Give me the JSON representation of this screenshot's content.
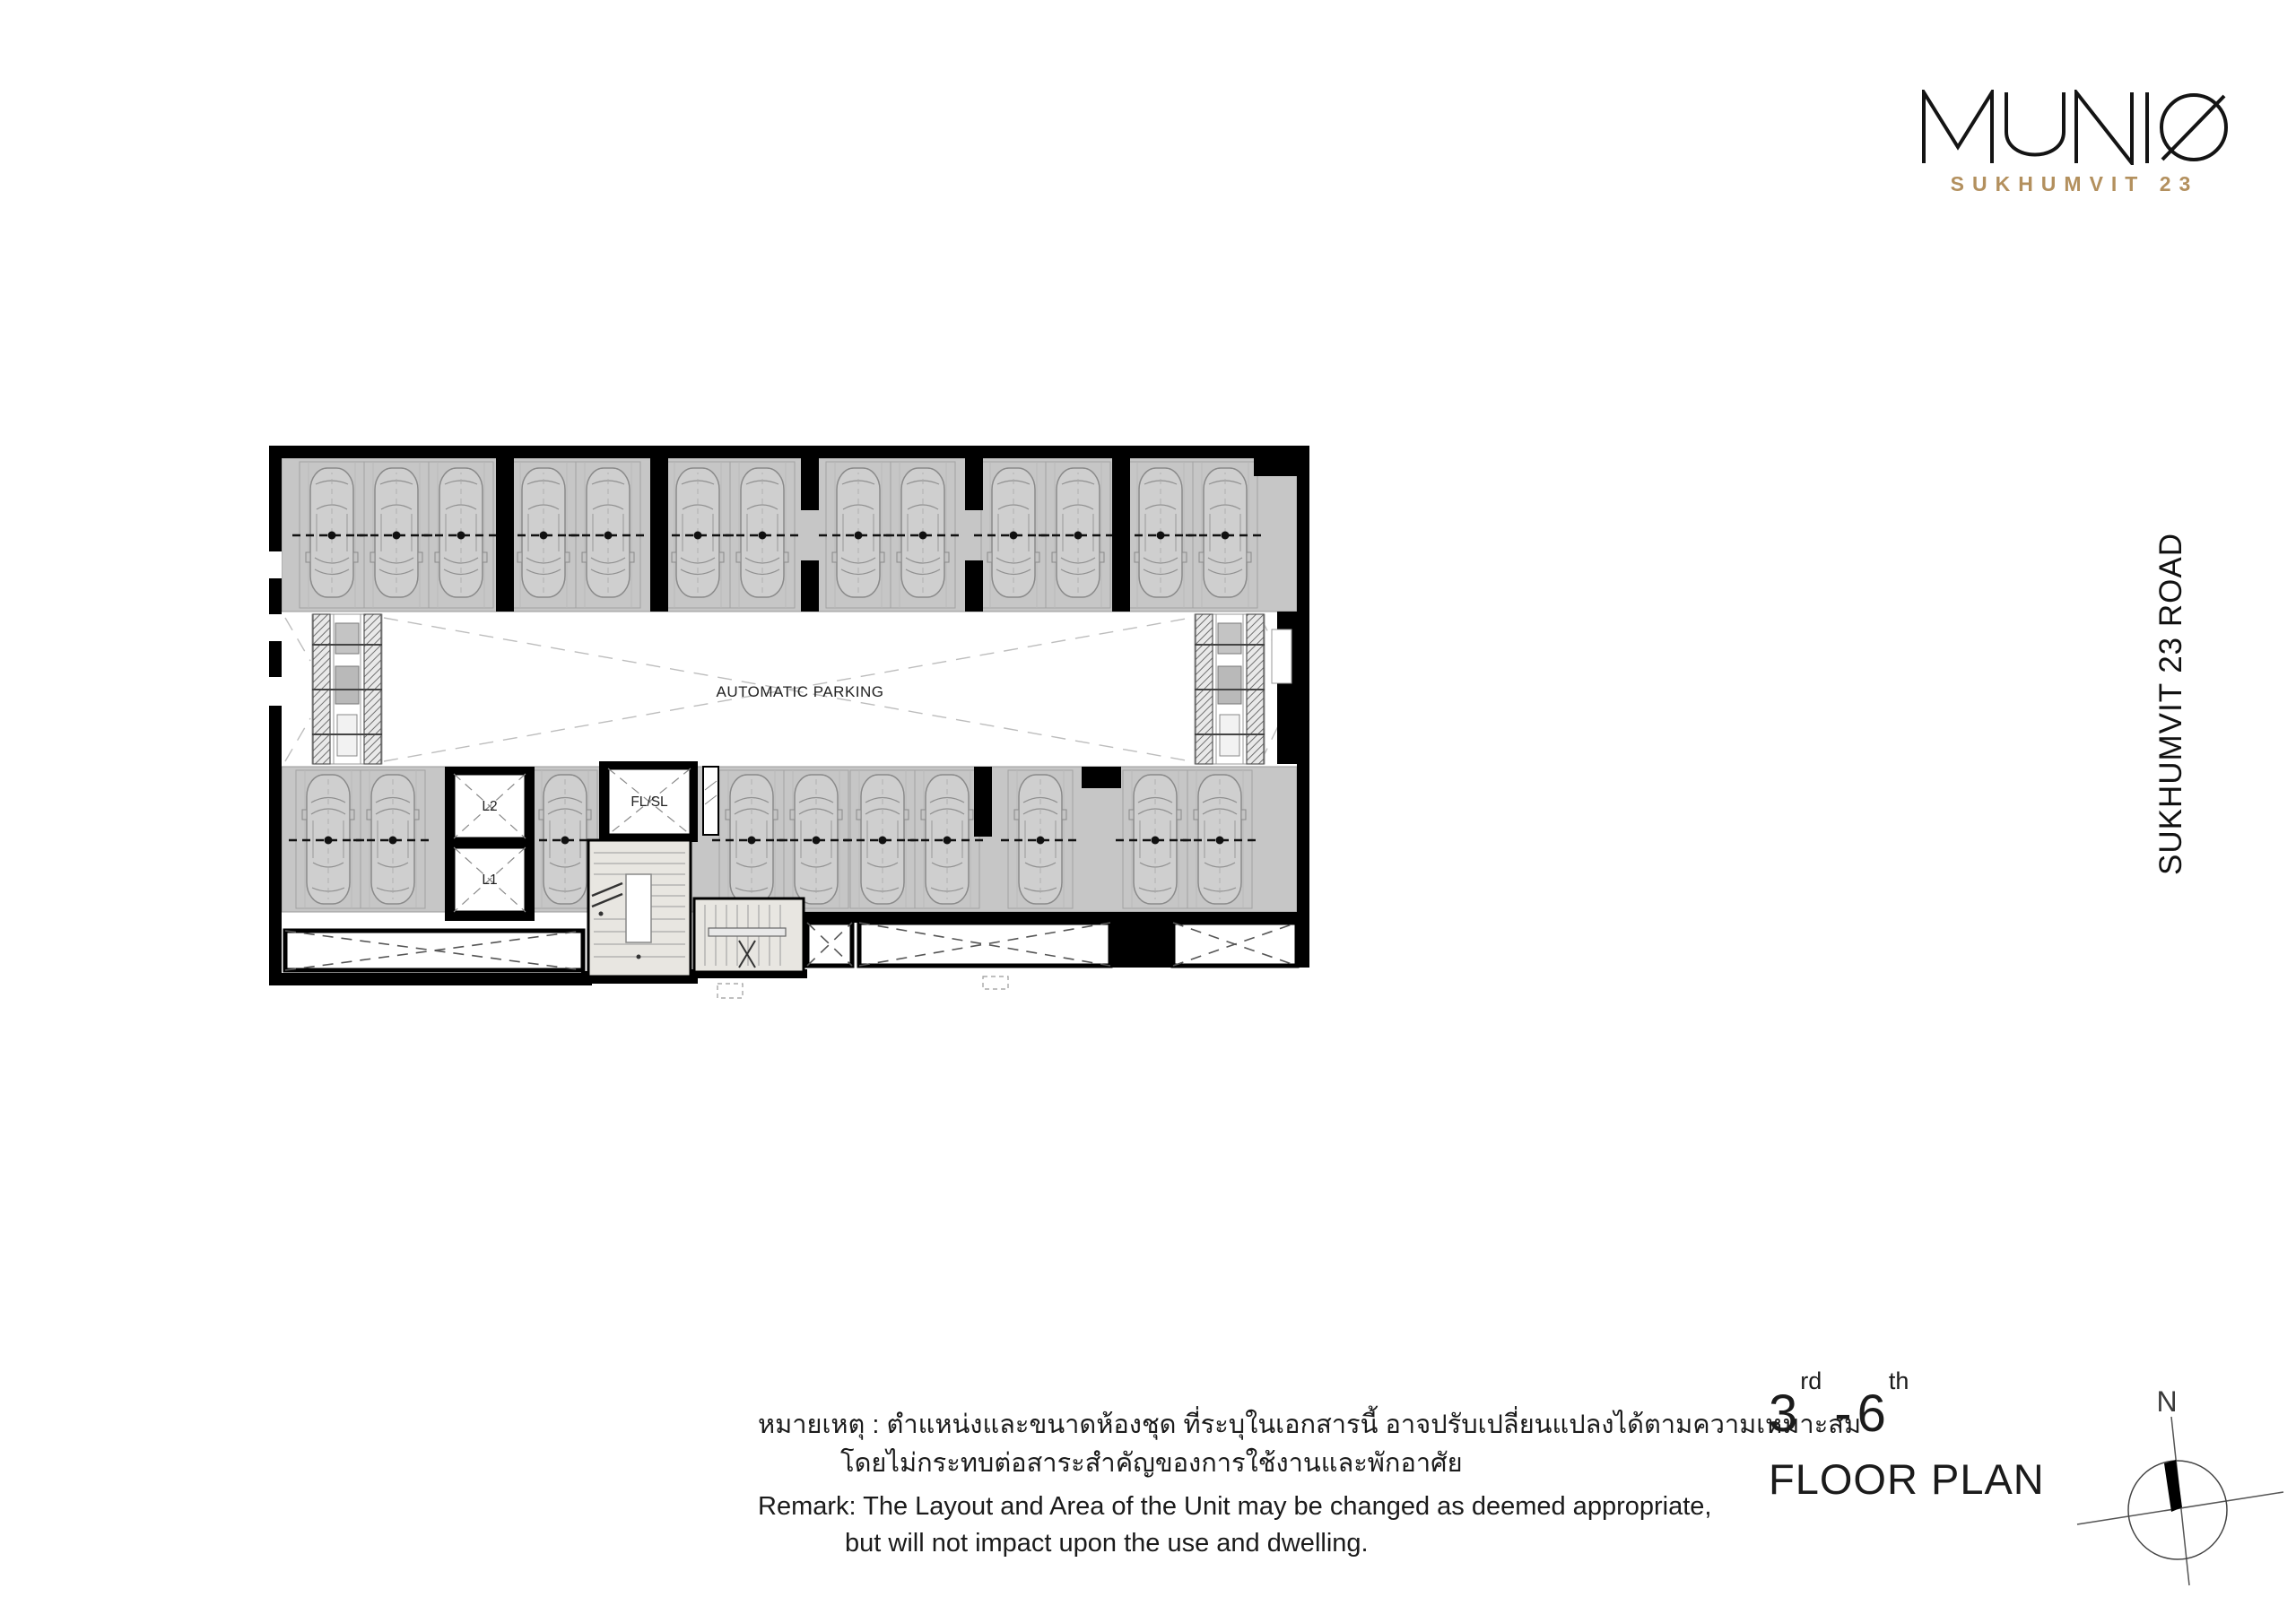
{
  "logo": {
    "title": "MUNIQ",
    "subtitle": "SUKHUMVIT 23"
  },
  "road_label": "SUKHUMVIT 23 ROAD",
  "plan": {
    "automatic_parking_label": "AUTOMATIC PARKING",
    "elevators": {
      "upper": "L2",
      "lower": "L1",
      "service": "FL/SL"
    },
    "top_row_cars_x": [
      40,
      112,
      184,
      276,
      348,
      448,
      520,
      627,
      699,
      800,
      872,
      964,
      1036
    ],
    "bottom_row_cars_x": [
      36,
      108,
      300,
      508,
      580,
      654,
      726,
      830,
      958,
      1030
    ]
  },
  "remark_thai": {
    "line1": "หมายเหตุ : ตำแหน่งและขนาดห้องชุด ที่ระบุในเอกสารนี้ อาจปรับเปลี่ยนแปลงได้ตามความเหมาะสม",
    "line2": "โดยไม่กระทบต่อสาระสำคัญของการใช้งานและพักอาศัย"
  },
  "remark_english": {
    "line1": "Remark: The Layout and Area of the Unit may be changed as deemed appropriate,",
    "line2": "but will not impact upon the use and dwelling."
  },
  "floor_title": {
    "range_start": "3",
    "range_start_suffix": "rd",
    "separator": "-",
    "range_end": "6",
    "range_end_suffix": "th",
    "label": "FLOOR PLAN"
  },
  "compass": {
    "north_label": "N"
  },
  "colors": {
    "accent_gold": "#b3905e",
    "stall_gray": "#c6c6c6",
    "stair_beige": "#e8e6e1",
    "wall_black": "#000000"
  }
}
